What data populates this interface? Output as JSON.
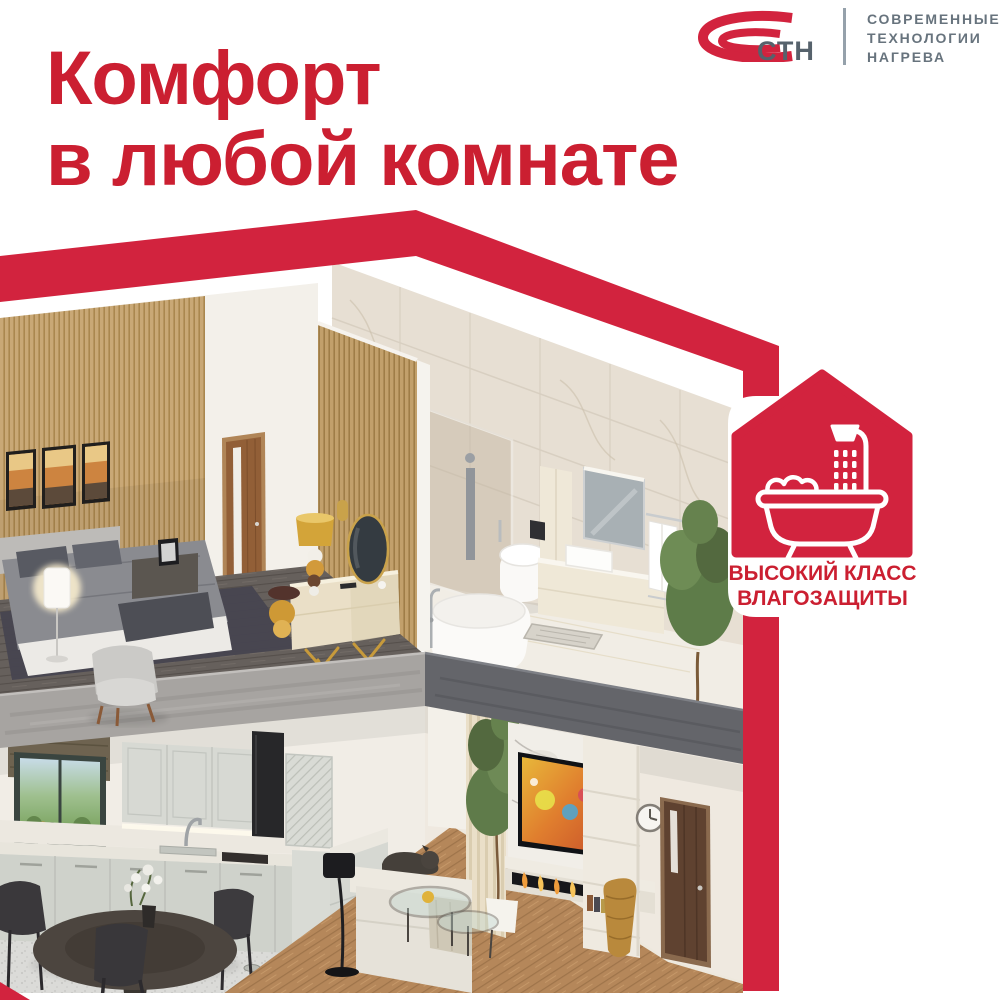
{
  "meta": {
    "type": "advertising-banner",
    "brand": "СТН"
  },
  "colors": {
    "brand_red": "#D2233E",
    "title_red": "#CB1F31",
    "logo_gray": "#56626C",
    "tagline_gray": "#67737D",
    "background": "#FFFFFF"
  },
  "header": {
    "title": {
      "line1": "Комфорт",
      "line2": "в любой комнате"
    }
  },
  "logo": {
    "abbr": "СТН",
    "tagline_lines": [
      "СОВРЕМЕННЫЕ",
      "ТЕХНОЛОГИИ",
      "НАГРЕВА"
    ],
    "mark": "stn-swoosh-icon"
  },
  "badge": {
    "line1": "ВЫСОКИЙ КЛАСС",
    "line2": "ВЛАГОЗАЩИТЫ",
    "icon": "bathtub-shower-icon"
  },
  "illustration": {
    "name": "isometric-house-cutaway",
    "alt": "Двухэтажный дом в разрезе: спальня и ванная наверху, кухня, столовая и гостиная внизу"
  }
}
